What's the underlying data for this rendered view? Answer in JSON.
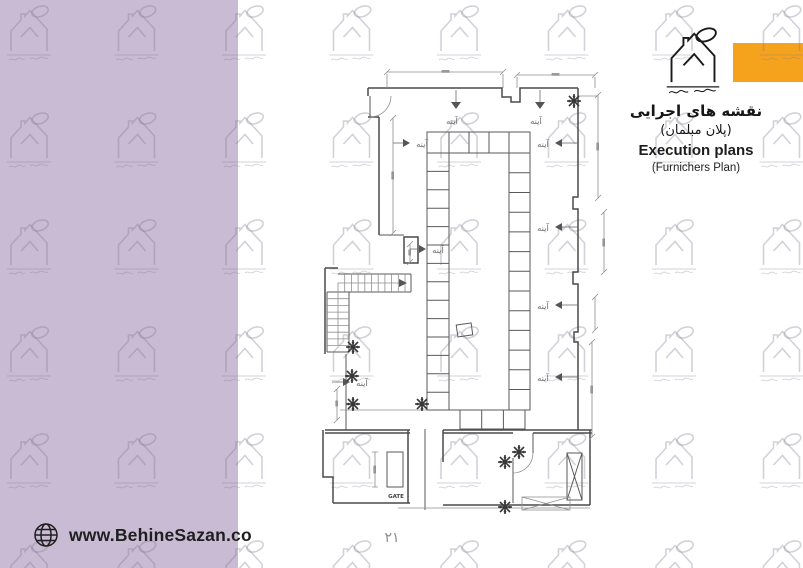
{
  "header": {
    "brand_icon": "house-gear-logo-icon",
    "title_fa": "نقشه های اجرایی",
    "subtitle_fa": "(پلان مبلمان)",
    "title_en": "Execution plans",
    "subtitle_en": "(Furnichers Plan)"
  },
  "plan": {
    "mirror_label": "آینه",
    "gate_label": "GATE",
    "plant_icon": "plant-icon",
    "elevator_icon": "elevator-x-shaft",
    "stair_icon": "staircase-with-direction-arrow"
  },
  "footer": {
    "globe_icon": "globe-icon",
    "website": "www.BehineSazan.co"
  },
  "page": {
    "number": "۲۱"
  },
  "colors": {
    "sidebar": "#c8bbd3",
    "accent_orange": "#f5a31d",
    "wall_line": "#4a4a4a",
    "watermark": "#7e778c"
  }
}
